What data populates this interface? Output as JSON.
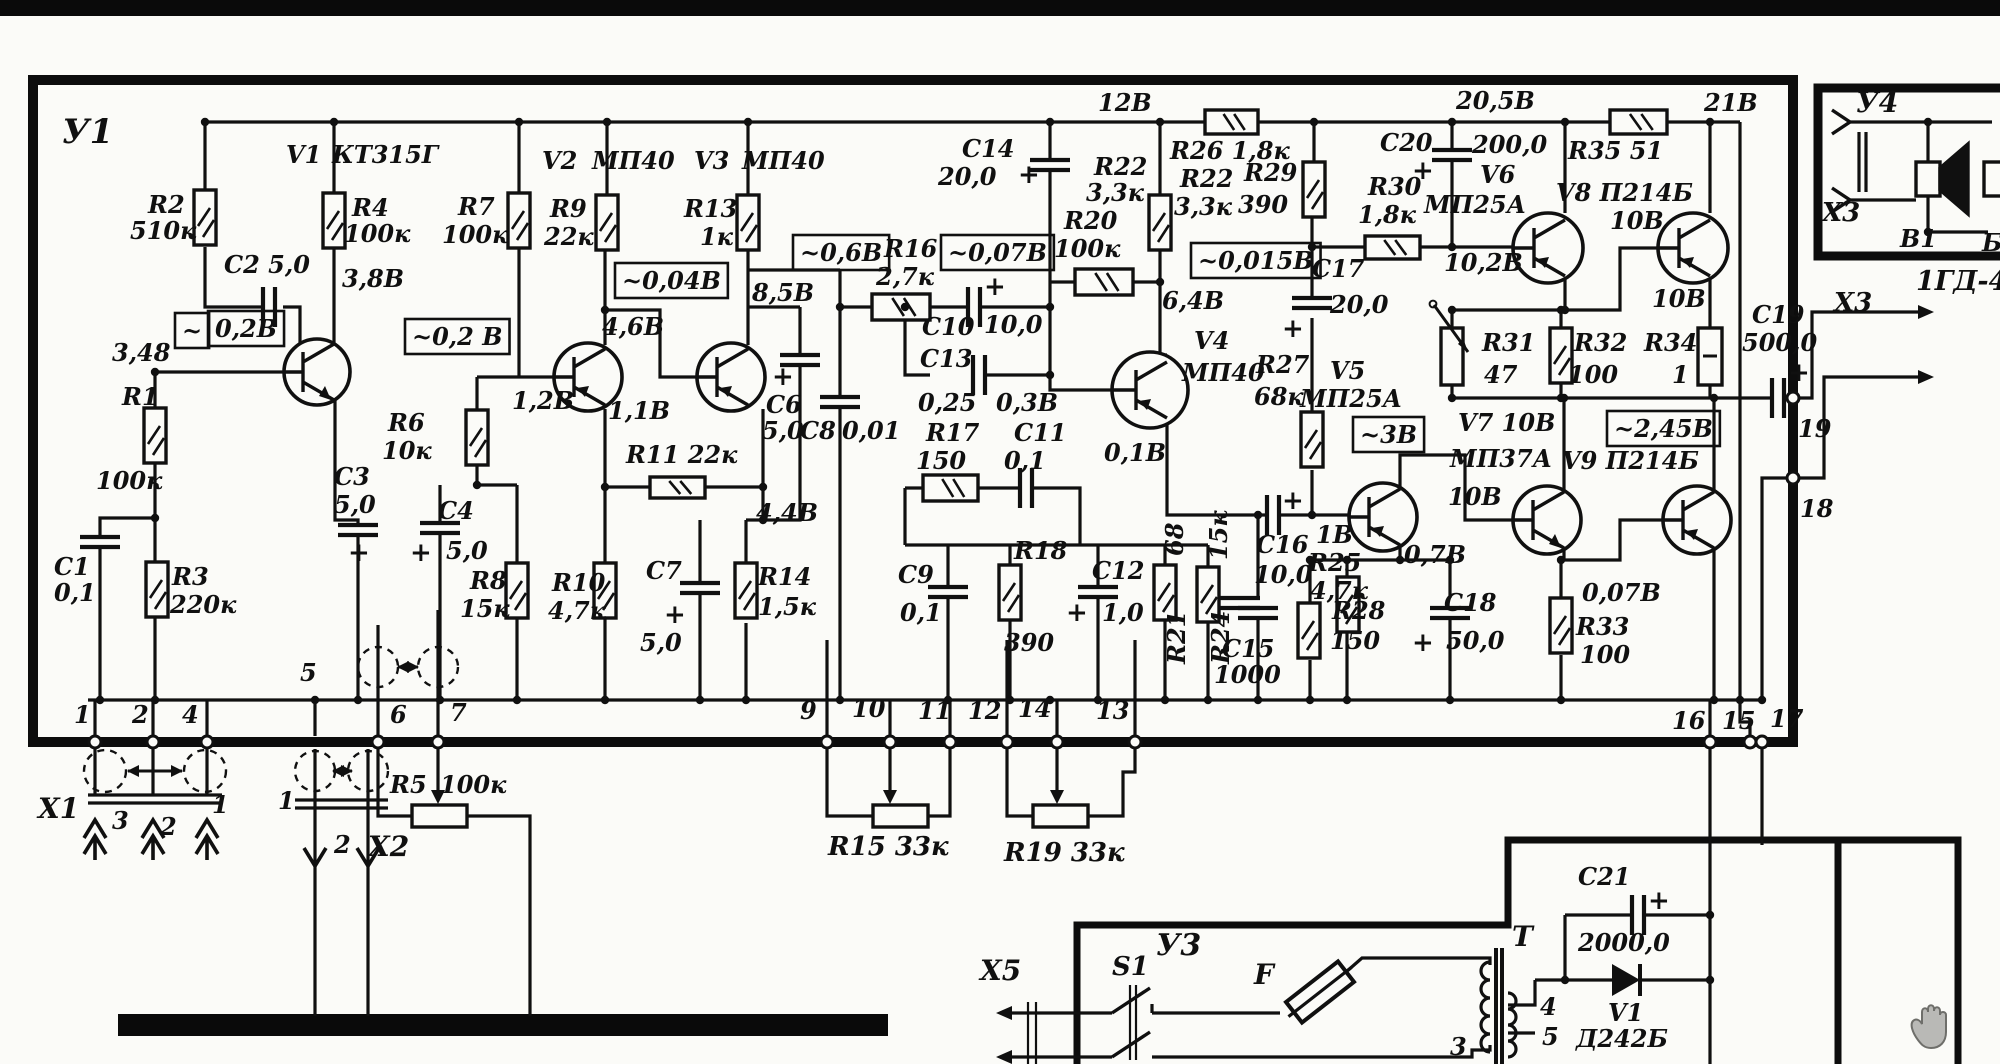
{
  "page": {
    "paper": "#fbfbf8",
    "ink": "#101010",
    "bar": "#0a0a0a",
    "cursor": "#9a9a9a"
  },
  "modules": {
    "main_board": "У1",
    "power_supply": "У3",
    "speaker_module": "У4",
    "transformer": "T",
    "speaker_type": "1ГД-4"
  },
  "labels": [
    {
      "text": "У1",
      "x": 62,
      "y": 112,
      "fs": 34,
      "kind": "module"
    },
    {
      "text": "V1",
      "x": 286,
      "y": 140,
      "kind": "component"
    },
    {
      "text": "КТ315Г",
      "x": 332,
      "y": 140,
      "kind": "component"
    },
    {
      "text": "R2",
      "x": 148,
      "y": 190,
      "kind": "component"
    },
    {
      "text": "510к",
      "x": 130,
      "y": 216,
      "kind": "component"
    },
    {
      "text": "C2 5,0",
      "x": 224,
      "y": 250,
      "kind": "component"
    },
    {
      "text": "R4",
      "x": 352,
      "y": 193,
      "kind": "component"
    },
    {
      "text": "100к",
      "x": 344,
      "y": 219,
      "kind": "component"
    },
    {
      "text": "3,8В",
      "x": 342,
      "y": 264,
      "kind": "voltage"
    },
    {
      "text": "~",
      "x": 182,
      "y": 316,
      "box": true,
      "kind": "voltage"
    },
    {
      "text": "0,2В",
      "x": 215,
      "y": 314,
      "box": true,
      "kind": "voltage"
    },
    {
      "text": "3,48",
      "x": 112,
      "y": 338,
      "kind": "voltage"
    },
    {
      "text": "R1",
      "x": 122,
      "y": 382,
      "kind": "component"
    },
    {
      "text": "100к",
      "x": 96,
      "y": 466,
      "kind": "component"
    },
    {
      "text": "C1",
      "x": 54,
      "y": 552,
      "kind": "component"
    },
    {
      "text": "0,1",
      "x": 54,
      "y": 578,
      "kind": "component"
    },
    {
      "text": "R3",
      "x": 172,
      "y": 562,
      "kind": "component"
    },
    {
      "text": "220к",
      "x": 170,
      "y": 590,
      "kind": "component"
    },
    {
      "text": "C3",
      "x": 334,
      "y": 462,
      "kind": "component"
    },
    {
      "text": "5,0",
      "x": 334,
      "y": 490,
      "kind": "component"
    },
    {
      "text": "+",
      "x": 348,
      "y": 538,
      "fs": 26,
      "kind": "polarity"
    },
    {
      "text": "R6",
      "x": 388,
      "y": 408,
      "kind": "component"
    },
    {
      "text": "10к",
      "x": 382,
      "y": 436,
      "kind": "component"
    },
    {
      "text": "C4",
      "x": 438,
      "y": 496,
      "kind": "component"
    },
    {
      "text": "5,0",
      "x": 446,
      "y": 536,
      "kind": "component"
    },
    {
      "text": "+",
      "x": 410,
      "y": 538,
      "fs": 26,
      "kind": "polarity"
    },
    {
      "text": "~0,2 В",
      "x": 412,
      "y": 322,
      "box": true,
      "kind": "voltage"
    },
    {
      "text": "V2",
      "x": 542,
      "y": 146,
      "kind": "component"
    },
    {
      "text": "МП40",
      "x": 592,
      "y": 146,
      "kind": "component"
    },
    {
      "text": "R7",
      "x": 458,
      "y": 192,
      "kind": "component"
    },
    {
      "text": "100к",
      "x": 442,
      "y": 220,
      "kind": "component"
    },
    {
      "text": "R9",
      "x": 550,
      "y": 194,
      "kind": "component"
    },
    {
      "text": "22к",
      "x": 544,
      "y": 222,
      "kind": "component"
    },
    {
      "text": "V3",
      "x": 694,
      "y": 146,
      "kind": "component"
    },
    {
      "text": "МП40",
      "x": 742,
      "y": 146,
      "kind": "component"
    },
    {
      "text": "R13",
      "x": 684,
      "y": 194,
      "kind": "component"
    },
    {
      "text": "1к",
      "x": 700,
      "y": 222,
      "kind": "component"
    },
    {
      "text": "~0,04В",
      "x": 622,
      "y": 266,
      "box": true,
      "kind": "voltage"
    },
    {
      "text": "8,5В",
      "x": 752,
      "y": 278,
      "kind": "voltage"
    },
    {
      "text": "4,6В",
      "x": 602,
      "y": 312,
      "kind": "voltage"
    },
    {
      "text": "1,2В",
      "x": 512,
      "y": 386,
      "kind": "voltage"
    },
    {
      "text": "1,1В",
      "x": 608,
      "y": 396,
      "kind": "voltage"
    },
    {
      "text": "R11 22к",
      "x": 626,
      "y": 440,
      "kind": "component"
    },
    {
      "text": "4,4В",
      "x": 756,
      "y": 498,
      "kind": "voltage"
    },
    {
      "text": "R8",
      "x": 470,
      "y": 566,
      "kind": "component"
    },
    {
      "text": "15к",
      "x": 460,
      "y": 594,
      "kind": "component"
    },
    {
      "text": "R10",
      "x": 552,
      "y": 568,
      "kind": "component"
    },
    {
      "text": "4,7к",
      "x": 548,
      "y": 596,
      "kind": "component"
    },
    {
      "text": "C7",
      "x": 646,
      "y": 556,
      "kind": "component"
    },
    {
      "text": "+",
      "x": 664,
      "y": 600,
      "fs": 26,
      "kind": "polarity"
    },
    {
      "text": "5,0",
      "x": 640,
      "y": 628,
      "kind": "component"
    },
    {
      "text": "R14",
      "x": 758,
      "y": 562,
      "kind": "component"
    },
    {
      "text": "1,5к",
      "x": 758,
      "y": 592,
      "kind": "component"
    },
    {
      "text": "С6",
      "x": 766,
      "y": 390,
      "kind": "component"
    },
    {
      "text": "5,0",
      "x": 762,
      "y": 416,
      "kind": "component"
    },
    {
      "text": "+",
      "x": 772,
      "y": 362,
      "fs": 26,
      "kind": "polarity"
    },
    {
      "text": "C8",
      "x": 800,
      "y": 416,
      "kind": "component"
    },
    {
      "text": "0,01",
      "x": 842,
      "y": 416,
      "kind": "component"
    },
    {
      "text": "~0,6В",
      "x": 800,
      "y": 238,
      "box": true,
      "kind": "voltage"
    },
    {
      "text": "R16",
      "x": 884,
      "y": 234,
      "kind": "component"
    },
    {
      "text": "2,7к",
      "x": 876,
      "y": 262,
      "kind": "component"
    },
    {
      "text": "~0,07В",
      "x": 948,
      "y": 238,
      "box": true,
      "kind": "voltage"
    },
    {
      "text": "C10",
      "x": 922,
      "y": 312,
      "kind": "component"
    },
    {
      "text": "10,0",
      "x": 984,
      "y": 310,
      "kind": "component"
    },
    {
      "text": "+",
      "x": 984,
      "y": 272,
      "fs": 26,
      "kind": "polarity"
    },
    {
      "text": "C13",
      "x": 920,
      "y": 344,
      "kind": "component"
    },
    {
      "text": "0,25",
      "x": 918,
      "y": 388,
      "kind": "voltage"
    },
    {
      "text": "0,3В",
      "x": 996,
      "y": 388,
      "kind": "voltage"
    },
    {
      "text": "R17",
      "x": 926,
      "y": 418,
      "kind": "component"
    },
    {
      "text": "150",
      "x": 916,
      "y": 446,
      "kind": "component"
    },
    {
      "text": "C11",
      "x": 1014,
      "y": 418,
      "kind": "component"
    },
    {
      "text": "0,1",
      "x": 1004,
      "y": 446,
      "kind": "component"
    },
    {
      "text": "C14",
      "x": 962,
      "y": 134,
      "kind": "component"
    },
    {
      "text": "20,0",
      "x": 938,
      "y": 162,
      "kind": "component"
    },
    {
      "text": "+",
      "x": 1018,
      "y": 160,
      "fs": 26,
      "kind": "polarity"
    },
    {
      "text": "12В",
      "x": 1098,
      "y": 88,
      "kind": "voltage"
    },
    {
      "text": "R22",
      "x": 1094,
      "y": 152,
      "kind": "component"
    },
    {
      "text": "3,3к",
      "x": 1086,
      "y": 178,
      "kind": "component"
    },
    {
      "text": "R20",
      "x": 1064,
      "y": 206,
      "kind": "component"
    },
    {
      "text": "100к",
      "x": 1054,
      "y": 234,
      "kind": "component"
    },
    {
      "text": "R26 1,8к",
      "x": 1170,
      "y": 136,
      "kind": "component"
    },
    {
      "text": "R22",
      "x": 1180,
      "y": 164,
      "kind": "component"
    },
    {
      "text": "3,3к",
      "x": 1174,
      "y": 192,
      "kind": "component"
    },
    {
      "text": "R29",
      "x": 1244,
      "y": 158,
      "kind": "component"
    },
    {
      "text": "390",
      "x": 1238,
      "y": 190,
      "kind": "component"
    },
    {
      "text": "~0,015В",
      "x": 1198,
      "y": 246,
      "box": true,
      "kind": "voltage"
    },
    {
      "text": "6,4В",
      "x": 1162,
      "y": 286,
      "kind": "voltage"
    },
    {
      "text": "V4",
      "x": 1194,
      "y": 326,
      "kind": "component"
    },
    {
      "text": "МП40",
      "x": 1182,
      "y": 358,
      "kind": "component"
    },
    {
      "text": "0,1В",
      "x": 1104,
      "y": 438,
      "kind": "voltage"
    },
    {
      "text": "C9",
      "x": 898,
      "y": 560,
      "kind": "component"
    },
    {
      "text": "0,1",
      "x": 900,
      "y": 598,
      "kind": "component"
    },
    {
      "text": "R18",
      "x": 1014,
      "y": 536,
      "kind": "component"
    },
    {
      "text": "390",
      "x": 1004,
      "y": 628,
      "kind": "component"
    },
    {
      "text": "C12",
      "x": 1092,
      "y": 556,
      "kind": "component"
    },
    {
      "text": "1,0",
      "x": 1102,
      "y": 598,
      "kind": "component"
    },
    {
      "text": "+",
      "x": 1066,
      "y": 598,
      "fs": 26,
      "kind": "polarity"
    },
    {
      "text": "68",
      "x": 1160,
      "y": 556,
      "r": -90,
      "kind": "component"
    },
    {
      "text": "R21",
      "x": 1162,
      "y": 664,
      "r": -90,
      "kind": "component"
    },
    {
      "text": "15к",
      "x": 1204,
      "y": 560,
      "r": -90,
      "kind": "component"
    },
    {
      "text": "R24",
      "x": 1206,
      "y": 664,
      "r": -90,
      "kind": "component"
    },
    {
      "text": "R27",
      "x": 1256,
      "y": 350,
      "kind": "component"
    },
    {
      "text": "68к",
      "x": 1254,
      "y": 382,
      "kind": "component"
    },
    {
      "text": "V5",
      "x": 1330,
      "y": 356,
      "kind": "component"
    },
    {
      "text": "МП25А",
      "x": 1300,
      "y": 384,
      "kind": "component"
    },
    {
      "text": "C17",
      "x": 1312,
      "y": 254,
      "kind": "component"
    },
    {
      "text": "20,0",
      "x": 1330,
      "y": 290,
      "kind": "component"
    },
    {
      "text": "+",
      "x": 1282,
      "y": 314,
      "fs": 26,
      "kind": "polarity"
    },
    {
      "text": "C20",
      "x": 1380,
      "y": 128,
      "kind": "component"
    },
    {
      "text": "200,0",
      "x": 1472,
      "y": 130,
      "kind": "component"
    },
    {
      "text": "+",
      "x": 1412,
      "y": 156,
      "fs": 26,
      "kind": "polarity"
    },
    {
      "text": "R30",
      "x": 1368,
      "y": 172,
      "kind": "component"
    },
    {
      "text": "1,8к",
      "x": 1358,
      "y": 200,
      "kind": "component"
    },
    {
      "text": "V6",
      "x": 1480,
      "y": 160,
      "kind": "component"
    },
    {
      "text": "МП25А",
      "x": 1424,
      "y": 190,
      "kind": "component"
    },
    {
      "text": "20,5В",
      "x": 1456,
      "y": 86,
      "kind": "voltage"
    },
    {
      "text": "R35 51",
      "x": 1568,
      "y": 136,
      "kind": "component"
    },
    {
      "text": "V8 П214Б",
      "x": 1556,
      "y": 178,
      "kind": "component"
    },
    {
      "text": "10В",
      "x": 1610,
      "y": 206,
      "kind": "voltage"
    },
    {
      "text": "21В",
      "x": 1704,
      "y": 88,
      "kind": "voltage"
    },
    {
      "text": "10,2В",
      "x": 1444,
      "y": 248,
      "kind": "voltage"
    },
    {
      "text": "10В",
      "x": 1652,
      "y": 284,
      "kind": "voltage"
    },
    {
      "text": "R31",
      "x": 1482,
      "y": 328,
      "kind": "component"
    },
    {
      "text": "47",
      "x": 1484,
      "y": 360,
      "kind": "component"
    },
    {
      "text": "R32",
      "x": 1574,
      "y": 328,
      "kind": "component"
    },
    {
      "text": "100",
      "x": 1568,
      "y": 360,
      "kind": "component"
    },
    {
      "text": "R34",
      "x": 1644,
      "y": 328,
      "kind": "component"
    },
    {
      "text": "1",
      "x": 1672,
      "y": 360,
      "kind": "component"
    },
    {
      "text": "C19",
      "x": 1752,
      "y": 300,
      "kind": "component"
    },
    {
      "text": "500,0",
      "x": 1742,
      "y": 328,
      "kind": "component"
    },
    {
      "text": "+",
      "x": 1788,
      "y": 358,
      "fs": 26,
      "kind": "polarity"
    },
    {
      "text": "~2,45В",
      "x": 1614,
      "y": 414,
      "box": true,
      "kind": "voltage"
    },
    {
      "text": "V7 10В",
      "x": 1458,
      "y": 408,
      "kind": "component"
    },
    {
      "text": "МП37А",
      "x": 1450,
      "y": 444,
      "kind": "component"
    },
    {
      "text": "10В",
      "x": 1448,
      "y": 482,
      "kind": "voltage"
    },
    {
      "text": "V9  П214Б",
      "x": 1562,
      "y": 446,
      "kind": "component"
    },
    {
      "text": "~3В",
      "x": 1360,
      "y": 420,
      "box": true,
      "kind": "voltage"
    },
    {
      "text": "C16",
      "x": 1256,
      "y": 530,
      "kind": "component"
    },
    {
      "text": "10,0",
      "x": 1254,
      "y": 560,
      "kind": "component"
    },
    {
      "text": "+",
      "x": 1282,
      "y": 486,
      "fs": 26,
      "kind": "polarity"
    },
    {
      "text": "1В",
      "x": 1316,
      "y": 520,
      "kind": "voltage"
    },
    {
      "text": "R25",
      "x": 1308,
      "y": 548,
      "kind": "component"
    },
    {
      "text": "4,7к",
      "x": 1310,
      "y": 576,
      "kind": "component"
    },
    {
      "text": "R28",
      "x": 1332,
      "y": 596,
      "kind": "component"
    },
    {
      "text": "150",
      "x": 1330,
      "y": 626,
      "kind": "component"
    },
    {
      "text": "0,7В",
      "x": 1404,
      "y": 540,
      "kind": "voltage"
    },
    {
      "text": "C18",
      "x": 1444,
      "y": 588,
      "kind": "component"
    },
    {
      "text": "50,0",
      "x": 1446,
      "y": 626,
      "kind": "component"
    },
    {
      "text": "+",
      "x": 1412,
      "y": 628,
      "fs": 26,
      "kind": "polarity"
    },
    {
      "text": "C15",
      "x": 1222,
      "y": 634,
      "kind": "component"
    },
    {
      "text": "1000",
      "x": 1214,
      "y": 660,
      "kind": "component"
    },
    {
      "text": "0,07В",
      "x": 1582,
      "y": 578,
      "kind": "voltage"
    },
    {
      "text": "R33",
      "x": 1576,
      "y": 612,
      "kind": "component"
    },
    {
      "text": "100",
      "x": 1580,
      "y": 640,
      "kind": "component"
    },
    {
      "text": "1",
      "x": 74,
      "y": 700,
      "kind": "pin"
    },
    {
      "text": "2",
      "x": 132,
      "y": 700,
      "kind": "pin"
    },
    {
      "text": "4",
      "x": 182,
      "y": 700,
      "kind": "pin"
    },
    {
      "text": "5",
      "x": 300,
      "y": 658,
      "kind": "pin"
    },
    {
      "text": "6",
      "x": 390,
      "y": 700,
      "kind": "pin"
    },
    {
      "text": "7",
      "x": 450,
      "y": 698,
      "kind": "pin"
    },
    {
      "text": "9",
      "x": 800,
      "y": 696,
      "kind": "pin"
    },
    {
      "text": "10",
      "x": 852,
      "y": 694,
      "kind": "pin"
    },
    {
      "text": "11",
      "x": 918,
      "y": 696,
      "kind": "pin"
    },
    {
      "text": "12",
      "x": 968,
      "y": 696,
      "kind": "pin"
    },
    {
      "text": "14",
      "x": 1018,
      "y": 694,
      "kind": "pin"
    },
    {
      "text": "13",
      "x": 1096,
      "y": 696,
      "kind": "pin"
    },
    {
      "text": "16",
      "x": 1672,
      "y": 706,
      "kind": "pin"
    },
    {
      "text": "15",
      "x": 1722,
      "y": 706,
      "kind": "pin"
    },
    {
      "text": "17",
      "x": 1770,
      "y": 704,
      "kind": "pin"
    },
    {
      "text": "19",
      "x": 1798,
      "y": 414,
      "kind": "pin"
    },
    {
      "text": "18",
      "x": 1800,
      "y": 494,
      "kind": "pin"
    },
    {
      "text": "X1",
      "x": 38,
      "y": 792,
      "fs": 28,
      "kind": "connector"
    },
    {
      "text": "3",
      "x": 112,
      "y": 806,
      "kind": "pin"
    },
    {
      "text": "2",
      "x": 160,
      "y": 812,
      "kind": "pin"
    },
    {
      "text": "1",
      "x": 212,
      "y": 790,
      "kind": "pin"
    },
    {
      "text": "1",
      "x": 278,
      "y": 786,
      "kind": "pin"
    },
    {
      "text": "2",
      "x": 334,
      "y": 830,
      "kind": "pin"
    },
    {
      "text": "X2",
      "x": 368,
      "y": 830,
      "fs": 28,
      "kind": "connector"
    },
    {
      "text": "R5",
      "x": 390,
      "y": 770,
      "kind": "component"
    },
    {
      "text": "100к",
      "x": 440,
      "y": 770,
      "kind": "component"
    },
    {
      "text": "R15 33к",
      "x": 828,
      "y": 832,
      "fs": 26,
      "kind": "component"
    },
    {
      "text": "R19 33к",
      "x": 1004,
      "y": 838,
      "fs": 26,
      "kind": "component"
    },
    {
      "text": "X3",
      "x": 1834,
      "y": 288,
      "fs": 26,
      "kind": "connector"
    },
    {
      "text": "X5",
      "x": 980,
      "y": 954,
      "fs": 28,
      "kind": "connector"
    },
    {
      "text": "S1",
      "x": 1112,
      "y": 952,
      "fs": 26,
      "kind": "component"
    },
    {
      "text": "У3",
      "x": 1156,
      "y": 928,
      "fs": 30,
      "kind": "module"
    },
    {
      "text": "F",
      "x": 1254,
      "y": 958,
      "fs": 28,
      "kind": "component"
    },
    {
      "text": "T",
      "x": 1512,
      "y": 920,
      "fs": 28,
      "kind": "component"
    },
    {
      "text": "C21",
      "x": 1578,
      "y": 862,
      "kind": "component"
    },
    {
      "text": "+",
      "x": 1648,
      "y": 886,
      "fs": 26,
      "kind": "polarity"
    },
    {
      "text": "2000,0",
      "x": 1578,
      "y": 928,
      "kind": "component"
    },
    {
      "text": "V1",
      "x": 1608,
      "y": 998,
      "kind": "component"
    },
    {
      "text": "Д242Б",
      "x": 1576,
      "y": 1024,
      "kind": "component"
    },
    {
      "text": "4",
      "x": 1540,
      "y": 992,
      "kind": "pin"
    },
    {
      "text": "5",
      "x": 1542,
      "y": 1022,
      "kind": "pin"
    },
    {
      "text": "3",
      "x": 1450,
      "y": 1032,
      "kind": "pin"
    },
    {
      "text": "У4",
      "x": 1856,
      "y": 86,
      "fs": 28,
      "kind": "module"
    },
    {
      "text": "X3",
      "x": 1822,
      "y": 198,
      "fs": 26,
      "kind": "connector"
    },
    {
      "text": "B1",
      "x": 1900,
      "y": 224,
      "kind": "component"
    },
    {
      "text": "Б",
      "x": 1982,
      "y": 228,
      "kind": "component"
    },
    {
      "text": "1ГД-4",
      "x": 1916,
      "y": 266,
      "fs": 27,
      "kind": "component"
    }
  ]
}
